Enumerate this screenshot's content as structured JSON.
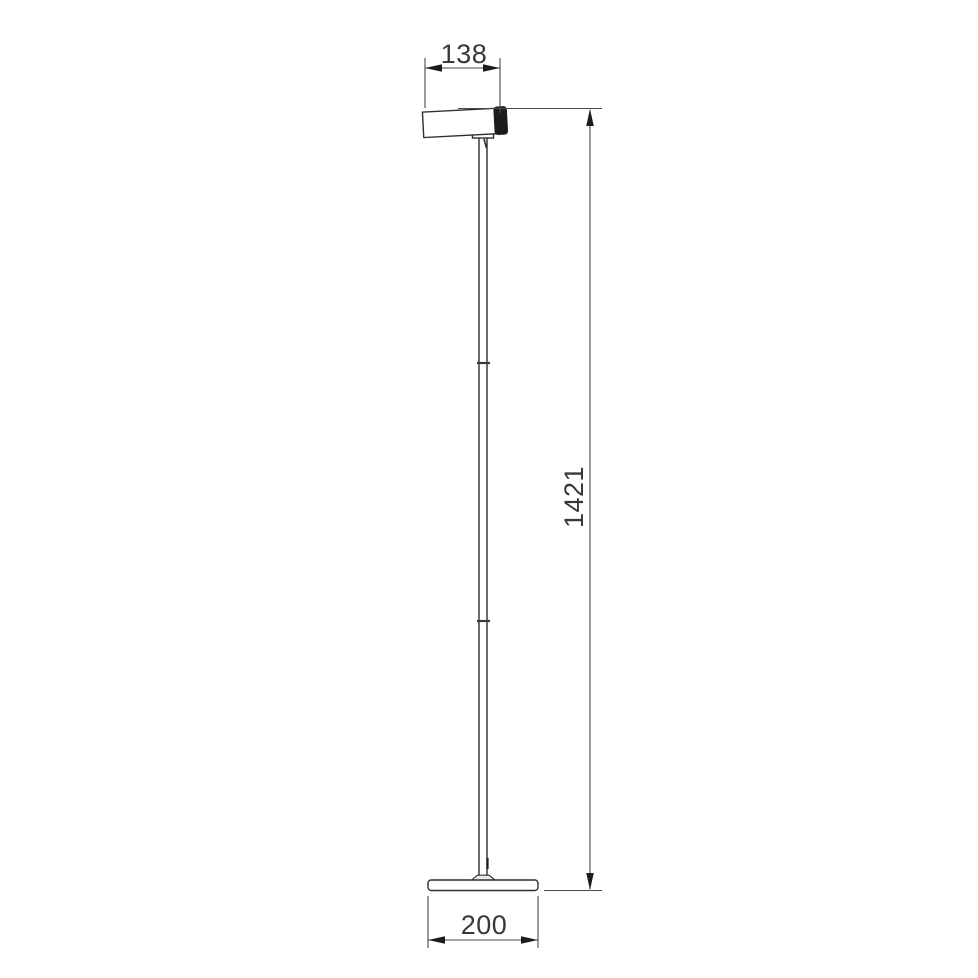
{
  "drawing": {
    "background": "#ffffff",
    "line_color": "#2e2e2e",
    "dimension_line_color": "#4a4a4a",
    "filled_part_color": "#1c1c1c",
    "label_color": "#383838",
    "dimensions": {
      "head_width": {
        "label": "138"
      },
      "overall_height": {
        "label": "1421"
      },
      "base_width": {
        "label": "200"
      }
    }
  }
}
